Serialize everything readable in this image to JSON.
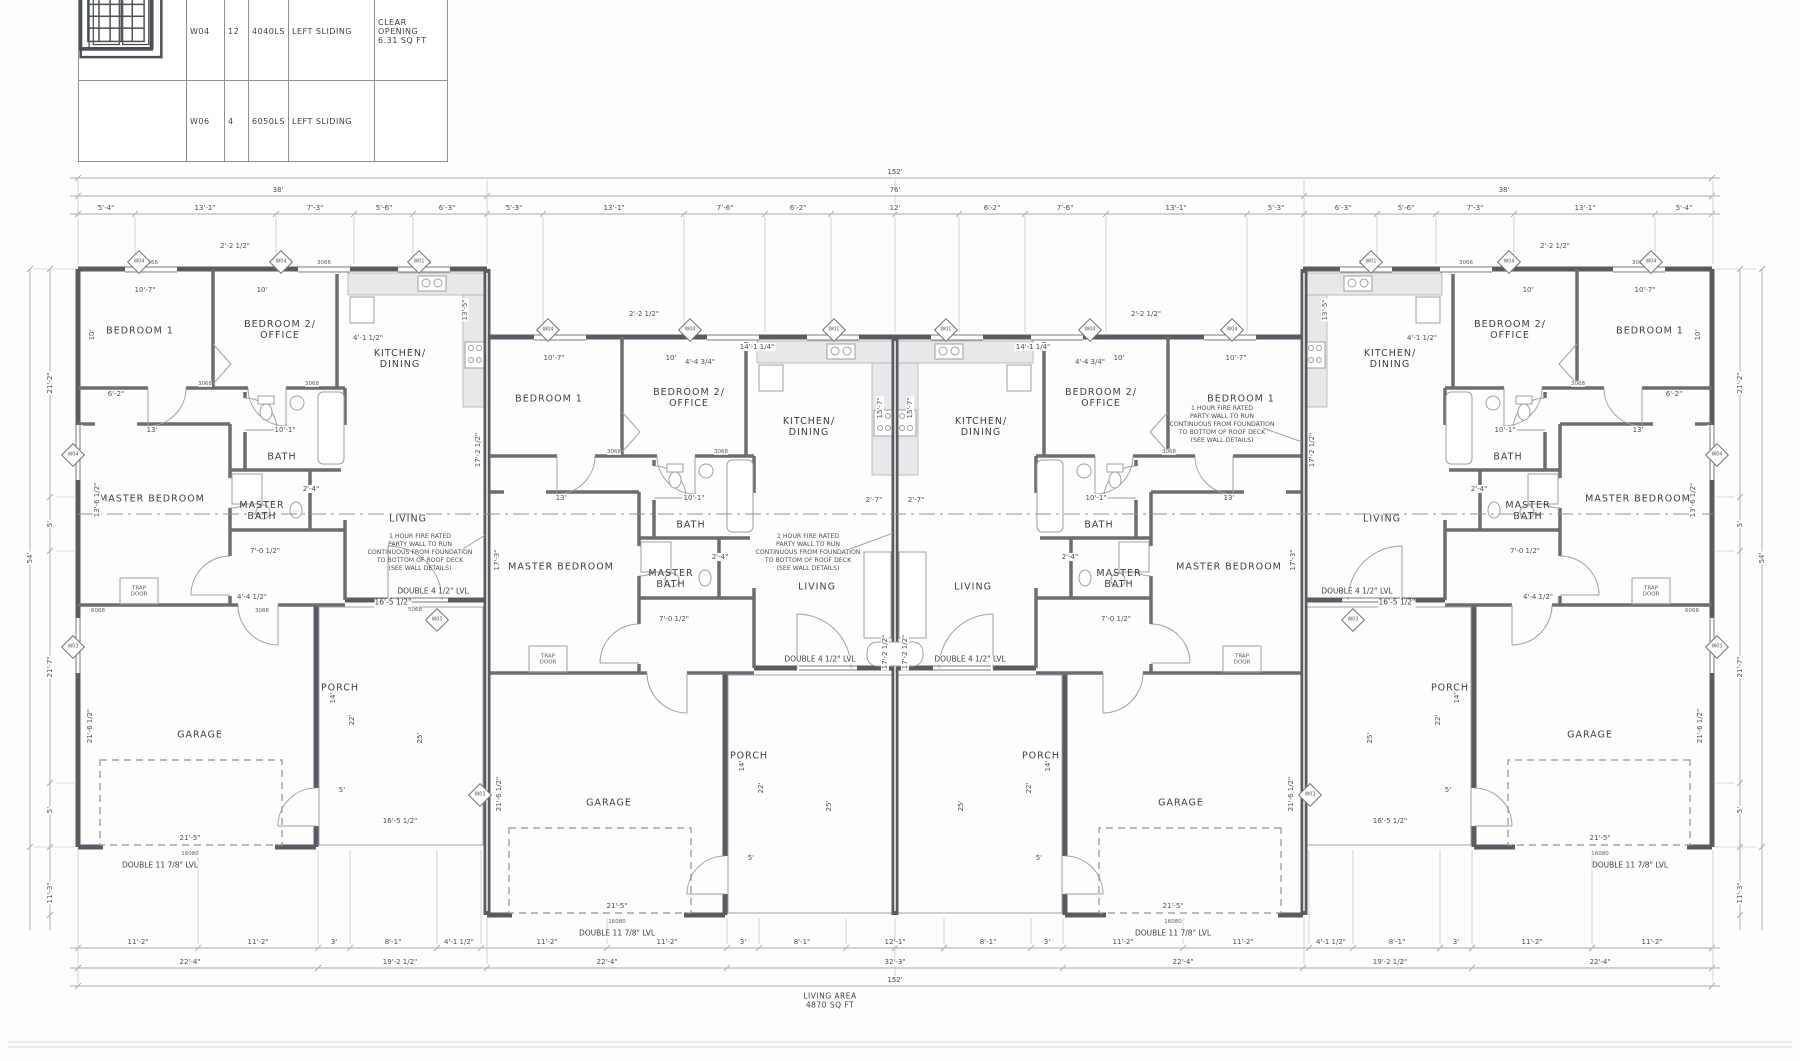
{
  "colors": {
    "wall": "#585c61",
    "interior_wall": "#6a6e73",
    "dim_text": "#4a4f55",
    "counter_fill": "#e7e8ea",
    "background": "#fdfdfd"
  },
  "schedule": {
    "rows": [
      {
        "glyph": "sliding-window",
        "id": "W04",
        "qty": "12",
        "size": "4040LS",
        "type": "LEFT SLIDING",
        "notes": "CLEAR OPENING\n6.31 SQ FT"
      },
      {
        "glyph": "grid-window",
        "id": "W06",
        "qty": "4",
        "size": "6050LS",
        "type": "LEFT SLIDING",
        "notes": ""
      }
    ]
  },
  "plan": {
    "living_area": {
      "t": "LIVING AREA|4870 SQ FT",
      "x": 830,
      "y": 1001
    },
    "rooms": [
      {
        "t": "BEDROOM 1",
        "x": 140,
        "y": 332
      },
      {
        "t": "BEDROOM 2/|OFFICE",
        "x": 280,
        "y": 331
      },
      {
        "t": "KITCHEN/|DINING",
        "x": 400,
        "y": 360
      },
      {
        "t": "BATH",
        "x": 282,
        "y": 458
      },
      {
        "t": "MASTER BEDROOM",
        "x": 152,
        "y": 500
      },
      {
        "t": "MASTER|BATH",
        "x": 262,
        "y": 512
      },
      {
        "t": "LIVING",
        "x": 408,
        "y": 520
      },
      {
        "t": "GARAGE",
        "x": 200,
        "y": 736
      },
      {
        "t": "PORCH",
        "x": 340,
        "y": 689
      },
      {
        "t": "BEDROOM 1",
        "x": 549,
        "y": 400
      },
      {
        "t": "BEDROOM 2/|OFFICE",
        "x": 689,
        "y": 399
      },
      {
        "t": "KITCHEN/|DINING",
        "x": 809,
        "y": 428
      },
      {
        "t": "BATH",
        "x": 691,
        "y": 526
      },
      {
        "t": "MASTER BEDROOM",
        "x": 561,
        "y": 568
      },
      {
        "t": "MASTER|BATH",
        "x": 671,
        "y": 580
      },
      {
        "t": "LIVING",
        "x": 817,
        "y": 588
      },
      {
        "t": "GARAGE",
        "x": 609,
        "y": 804
      },
      {
        "t": "PORCH",
        "x": 749,
        "y": 757
      },
      {
        "t": "BEDROOM 1",
        "x": 1241,
        "y": 400
      },
      {
        "t": "BEDROOM 2/|OFFICE",
        "x": 1101,
        "y": 399
      },
      {
        "t": "KITCHEN/|DINING",
        "x": 981,
        "y": 428
      },
      {
        "t": "BATH",
        "x": 1099,
        "y": 526
      },
      {
        "t": "MASTER BEDROOM",
        "x": 1229,
        "y": 568
      },
      {
        "t": "MASTER|BATH",
        "x": 1119,
        "y": 580
      },
      {
        "t": "LIVING",
        "x": 973,
        "y": 588
      },
      {
        "t": "GARAGE",
        "x": 1181,
        "y": 804
      },
      {
        "t": "PORCH",
        "x": 1041,
        "y": 757
      },
      {
        "t": "BEDROOM 1",
        "x": 1650,
        "y": 332
      },
      {
        "t": "BEDROOM 2/|OFFICE",
        "x": 1510,
        "y": 331
      },
      {
        "t": "KITCHEN/|DINING",
        "x": 1390,
        "y": 360
      },
      {
        "t": "BATH",
        "x": 1508,
        "y": 458
      },
      {
        "t": "MASTER BEDROOM",
        "x": 1638,
        "y": 500
      },
      {
        "t": "MASTER|BATH",
        "x": 1528,
        "y": 512
      },
      {
        "t": "LIVING",
        "x": 1382,
        "y": 520
      },
      {
        "t": "GARAGE",
        "x": 1590,
        "y": 736
      },
      {
        "t": "PORCH",
        "x": 1450,
        "y": 689
      }
    ],
    "notes": [
      {
        "t": "1 HOUR FIRE RATED|PARTY WALL TO RUN|CONTINUOUS FROM FOUNDATION|TO BOTTOM OF ROOF DECK|(SEE WALL DETAILS)",
        "x": 420,
        "y": 553
      },
      {
        "t": "1 HOUR FIRE RATED|PARTY WALL TO RUN|CONTINUOUS FROM FOUNDATION|TO BOTTOM OF ROOF DECK|(SEE WALL DETAILS)",
        "x": 808,
        "y": 553
      },
      {
        "t": "1 HOUR FIRE RATED|PARTY WALL TO RUN|CONTINUOUS FROM FOUNDATION|TO BOTTOM OF ROOF DECK|(SEE WALL DETAILS)",
        "x": 1222,
        "y": 425
      }
    ],
    "beams": [
      {
        "t": "DOUBLE 4 1/2\" LVL",
        "x": 433,
        "y": 592
      },
      {
        "t": "16'-5 1/2\"",
        "x": 393,
        "y": 603
      },
      {
        "t": "DOUBLE 4 1/2\" LVL",
        "x": 820,
        "y": 660
      },
      {
        "t": "DOUBLE 4 1/2\" LVL",
        "x": 970,
        "y": 660
      },
      {
        "t": "DOUBLE 4 1/2\" LVL",
        "x": 1357,
        "y": 592
      },
      {
        "t": "16'-5 1/2\"",
        "x": 1397,
        "y": 603
      },
      {
        "t": "DOUBLE 11 7/8\" LVL",
        "x": 160,
        "y": 866
      },
      {
        "t": "DOUBLE 11 7/8\" LVL",
        "x": 617,
        "y": 934
      },
      {
        "t": "DOUBLE 11 7/8\" LVL",
        "x": 1173,
        "y": 934
      },
      {
        "t": "DOUBLE 11 7/8\" LVL",
        "x": 1630,
        "y": 866
      }
    ],
    "window_tags": [
      {
        "t": "W04",
        "x": 139,
        "y": 262
      },
      {
        "t": "W04",
        "x": 281,
        "y": 262
      },
      {
        "t": "W01",
        "x": 419,
        "y": 262
      },
      {
        "t": "W04",
        "x": 548,
        "y": 330
      },
      {
        "t": "W04",
        "x": 690,
        "y": 330
      },
      {
        "t": "W01",
        "x": 834,
        "y": 330
      },
      {
        "t": "W01",
        "x": 946,
        "y": 330
      },
      {
        "t": "W04",
        "x": 1090,
        "y": 330
      },
      {
        "t": "W04",
        "x": 1232,
        "y": 330
      },
      {
        "t": "W01",
        "x": 1371,
        "y": 262
      },
      {
        "t": "W04",
        "x": 1509,
        "y": 262
      },
      {
        "t": "W04",
        "x": 1651,
        "y": 262
      },
      {
        "t": "W04",
        "x": 73,
        "y": 455
      },
      {
        "t": "W03",
        "x": 73,
        "y": 647
      },
      {
        "t": "W04",
        "x": 1717,
        "y": 455
      },
      {
        "t": "W03",
        "x": 1717,
        "y": 647
      },
      {
        "t": "W03",
        "x": 437,
        "y": 620
      },
      {
        "t": "W03",
        "x": 480,
        "y": 795
      },
      {
        "t": "W03",
        "x": 1353,
        "y": 620
      },
      {
        "t": "W03",
        "x": 1310,
        "y": 795
      }
    ],
    "dims": [
      {
        "t": "152'",
        "x": 895,
        "y": 172
      },
      {
        "t": "38'",
        "x": 278,
        "y": 190
      },
      {
        "t": "76'",
        "x": 895,
        "y": 190
      },
      {
        "t": "38'",
        "x": 1504,
        "y": 190
      },
      {
        "t": "5'-4\"",
        "x": 106,
        "y": 208
      },
      {
        "t": "13'-1\"",
        "x": 205,
        "y": 208
      },
      {
        "t": "7'-3\"",
        "x": 315,
        "y": 208
      },
      {
        "t": "5'-6\"",
        "x": 384,
        "y": 208
      },
      {
        "t": "6'-3\"",
        "x": 447,
        "y": 208
      },
      {
        "t": "5'-3\"",
        "x": 514,
        "y": 208
      },
      {
        "t": "13'-1\"",
        "x": 614,
        "y": 208
      },
      {
        "t": "7'-6\"",
        "x": 725,
        "y": 208
      },
      {
        "t": "6'-2\"",
        "x": 798,
        "y": 208
      },
      {
        "t": "12'",
        "x": 895,
        "y": 208
      },
      {
        "t": "6'-2\"",
        "x": 992,
        "y": 208
      },
      {
        "t": "7'-6\"",
        "x": 1065,
        "y": 208
      },
      {
        "t": "13'-1\"",
        "x": 1176,
        "y": 208
      },
      {
        "t": "5'-3\"",
        "x": 1276,
        "y": 208
      },
      {
        "t": "6'-3\"",
        "x": 1343,
        "y": 208
      },
      {
        "t": "5'-6\"",
        "x": 1406,
        "y": 208
      },
      {
        "t": "7'-3\"",
        "x": 1475,
        "y": 208
      },
      {
        "t": "13'-1\"",
        "x": 1585,
        "y": 208
      },
      {
        "t": "5'-4\"",
        "x": 1684,
        "y": 208
      },
      {
        "t": "2'-2 1/2\"",
        "x": 235,
        "y": 246
      },
      {
        "t": "2'-2 1/2\"",
        "x": 1555,
        "y": 246
      },
      {
        "t": "2'-2 1/2\"",
        "x": 644,
        "y": 314
      },
      {
        "t": "2'-2 1/2\"",
        "x": 1146,
        "y": 314
      },
      {
        "t": "11'-2\"",
        "x": 138,
        "y": 942
      },
      {
        "t": "11'-2\"",
        "x": 258,
        "y": 942
      },
      {
        "t": "3'",
        "x": 334,
        "y": 942
      },
      {
        "t": "8'-1\"",
        "x": 393,
        "y": 942
      },
      {
        "t": "4'-1 1/2\"",
        "x": 459,
        "y": 942
      },
      {
        "t": "11'-2\"",
        "x": 547,
        "y": 942
      },
      {
        "t": "11'-2\"",
        "x": 667,
        "y": 942
      },
      {
        "t": "3'",
        "x": 743,
        "y": 942
      },
      {
        "t": "8'-1\"",
        "x": 802,
        "y": 942
      },
      {
        "t": "12'-1\"",
        "x": 895,
        "y": 942
      },
      {
        "t": "8'-1\"",
        "x": 988,
        "y": 942
      },
      {
        "t": "3'",
        "x": 1047,
        "y": 942
      },
      {
        "t": "11'-2\"",
        "x": 1123,
        "y": 942
      },
      {
        "t": "11'-2\"",
        "x": 1243,
        "y": 942
      },
      {
        "t": "4'-1 1/2\"",
        "x": 1331,
        "y": 942
      },
      {
        "t": "8'-1\"",
        "x": 1397,
        "y": 942
      },
      {
        "t": "3'",
        "x": 1456,
        "y": 942
      },
      {
        "t": "11'-2\"",
        "x": 1532,
        "y": 942
      },
      {
        "t": "11'-2\"",
        "x": 1652,
        "y": 942
      },
      {
        "t": "22'-4\"",
        "x": 190,
        "y": 962
      },
      {
        "t": "19'-2 1/2\"",
        "x": 400,
        "y": 962
      },
      {
        "t": "22'-4\"",
        "x": 607,
        "y": 962
      },
      {
        "t": "32'-3\"",
        "x": 895,
        "y": 962
      },
      {
        "t": "22'-4\"",
        "x": 1183,
        "y": 962
      },
      {
        "t": "19'-2 1/2\"",
        "x": 1390,
        "y": 962
      },
      {
        "t": "22'-4\"",
        "x": 1600,
        "y": 962
      },
      {
        "t": "152'",
        "x": 895,
        "y": 980
      },
      {
        "t": "54'",
        "x": 30,
        "y": 558,
        "r": 1
      },
      {
        "t": "21'-2\"",
        "x": 50,
        "y": 383,
        "r": 1
      },
      {
        "t": "5'",
        "x": 50,
        "y": 524,
        "r": 1
      },
      {
        "t": "21'-7\"",
        "x": 50,
        "y": 667,
        "r": 1
      },
      {
        "t": "5'",
        "x": 50,
        "y": 810,
        "r": 1
      },
      {
        "t": "11'-3\"",
        "x": 50,
        "y": 893,
        "r": 1
      },
      {
        "t": "54'",
        "x": 1762,
        "y": 558,
        "r": 1
      },
      {
        "t": "21'-2\"",
        "x": 1740,
        "y": 383,
        "r": 1
      },
      {
        "t": "5'",
        "x": 1740,
        "y": 524,
        "r": 1
      },
      {
        "t": "21'-7\"",
        "x": 1740,
        "y": 667,
        "r": 1
      },
      {
        "t": "5'",
        "x": 1740,
        "y": 810,
        "r": 1
      },
      {
        "t": "11'-3\"",
        "x": 1740,
        "y": 893,
        "r": 1
      },
      {
        "t": "10'-7\"",
        "x": 145,
        "y": 290
      },
      {
        "t": "10'",
        "x": 262,
        "y": 290
      },
      {
        "t": "4'-1 1/2\"",
        "x": 368,
        "y": 338
      },
      {
        "t": "13'-5\"",
        "x": 465,
        "y": 310,
        "r": 1
      },
      {
        "t": "10'",
        "x": 92,
        "y": 335,
        "r": 1
      },
      {
        "t": "6'-2\"",
        "x": 116,
        "y": 394
      },
      {
        "t": "13'",
        "x": 152,
        "y": 430
      },
      {
        "t": "10'-1\"",
        "x": 285,
        "y": 430
      },
      {
        "t": "13'-6 1/2\"",
        "x": 97,
        "y": 500,
        "r": 1
      },
      {
        "t": "7'-0 1/2\"",
        "x": 265,
        "y": 551
      },
      {
        "t": "2'-4\"",
        "x": 311,
        "y": 489
      },
      {
        "t": "4'-4 1/2\"",
        "x": 252,
        "y": 597
      },
      {
        "t": "10'-7\"",
        "x": 1645,
        "y": 290
      },
      {
        "t": "10'",
        "x": 1528,
        "y": 290
      },
      {
        "t": "4'-1 1/2\"",
        "x": 1422,
        "y": 338
      },
      {
        "t": "13'-5\"",
        "x": 1325,
        "y": 310,
        "r": 1
      },
      {
        "t": "10'",
        "x": 1698,
        "y": 335,
        "r": 1
      },
      {
        "t": "6'-2\"",
        "x": 1674,
        "y": 394
      },
      {
        "t": "13'",
        "x": 1638,
        "y": 430
      },
      {
        "t": "10'-1\"",
        "x": 1505,
        "y": 430
      },
      {
        "t": "13'-6 1/2\"",
        "x": 1693,
        "y": 500,
        "r": 1
      },
      {
        "t": "7'-0 1/2\"",
        "x": 1525,
        "y": 551
      },
      {
        "t": "2'-4\"",
        "x": 1479,
        "y": 489
      },
      {
        "t": "4'-4 1/2\"",
        "x": 1538,
        "y": 597
      },
      {
        "t": "10'-7\"",
        "x": 554,
        "y": 358
      },
      {
        "t": "10'",
        "x": 671,
        "y": 358
      },
      {
        "t": "13'",
        "x": 561,
        "y": 498
      },
      {
        "t": "10'-1\"",
        "x": 694,
        "y": 498
      },
      {
        "t": "7'-0 1/2\"",
        "x": 674,
        "y": 619
      },
      {
        "t": "2'-4\"",
        "x": 720,
        "y": 557
      },
      {
        "t": "10'-7\"",
        "x": 1236,
        "y": 358
      },
      {
        "t": "10'",
        "x": 1119,
        "y": 358
      },
      {
        "t": "13'",
        "x": 1229,
        "y": 498
      },
      {
        "t": "10'-1\"",
        "x": 1096,
        "y": 498
      },
      {
        "t": "7'-0 1/2\"",
        "x": 1116,
        "y": 619
      },
      {
        "t": "2'-4\"",
        "x": 1070,
        "y": 557
      },
      {
        "t": "14'-1 1/4\"",
        "x": 757,
        "y": 347
      },
      {
        "t": "14'-1 1/4\"",
        "x": 1033,
        "y": 347
      },
      {
        "t": "4'-4 3/4\"",
        "x": 700,
        "y": 362
      },
      {
        "t": "4'-4 3/4\"",
        "x": 1090,
        "y": 362
      },
      {
        "t": "15'-7\"",
        "x": 880,
        "y": 408,
        "r": 1
      },
      {
        "t": "15'-7\"",
        "x": 910,
        "y": 408,
        "r": 1
      },
      {
        "t": "2'-7\"",
        "x": 874,
        "y": 500
      },
      {
        "t": "2'-7\"",
        "x": 916,
        "y": 500
      },
      {
        "t": "17'-2 1/2\"",
        "x": 885,
        "y": 652,
        "r": 1
      },
      {
        "t": "17'-2 1/2\"",
        "x": 905,
        "y": 652,
        "r": 1
      },
      {
        "t": "17'-3\"",
        "x": 497,
        "y": 560,
        "r": 1
      },
      {
        "t": "17'-3\"",
        "x": 1293,
        "y": 560,
        "r": 1
      },
      {
        "t": "17'-2 1/2\"",
        "x": 478,
        "y": 450,
        "r": 1
      },
      {
        "t": "17'-2 1/2\"",
        "x": 1312,
        "y": 450,
        "r": 1
      },
      {
        "t": "16'-5 1/2\"",
        "x": 400,
        "y": 821
      },
      {
        "t": "16'-5 1/2\"",
        "x": 1390,
        "y": 821
      },
      {
        "t": "21'-5\"",
        "x": 190,
        "y": 838
      },
      {
        "t": "21'-5\"",
        "x": 617,
        "y": 906
      },
      {
        "t": "21'-5\"",
        "x": 1173,
        "y": 906
      },
      {
        "t": "21'-5\"",
        "x": 1600,
        "y": 838
      },
      {
        "t": "21'-6 1/2\"",
        "x": 90,
        "y": 726,
        "r": 1
      },
      {
        "t": "21'-6 1/2\"",
        "x": 1700,
        "y": 726,
        "r": 1
      },
      {
        "t": "21'-6 1/2\"",
        "x": 499,
        "y": 794,
        "r": 1
      },
      {
        "t": "21'-6 1/2\"",
        "x": 1291,
        "y": 794,
        "r": 1
      },
      {
        "t": "14'",
        "x": 333,
        "y": 698,
        "r": 1
      },
      {
        "t": "22'",
        "x": 352,
        "y": 720,
        "r": 1
      },
      {
        "t": "25'",
        "x": 420,
        "y": 738,
        "r": 1
      },
      {
        "t": "5'",
        "x": 342,
        "y": 790
      },
      {
        "t": "14'",
        "x": 742,
        "y": 766,
        "r": 1
      },
      {
        "t": "22'",
        "x": 761,
        "y": 788,
        "r": 1
      },
      {
        "t": "25'",
        "x": 829,
        "y": 806,
        "r": 1
      },
      {
        "t": "5'",
        "x": 751,
        "y": 858
      },
      {
        "t": "14'",
        "x": 1048,
        "y": 766,
        "r": 1
      },
      {
        "t": "22'",
        "x": 1029,
        "y": 788,
        "r": 1
      },
      {
        "t": "25'",
        "x": 961,
        "y": 806,
        "r": 1
      },
      {
        "t": "5'",
        "x": 1039,
        "y": 858
      },
      {
        "t": "14'",
        "x": 1457,
        "y": 698,
        "r": 1
      },
      {
        "t": "22'",
        "x": 1438,
        "y": 720,
        "r": 1
      },
      {
        "t": "25'",
        "x": 1370,
        "y": 738,
        "r": 1
      },
      {
        "t": "5'",
        "x": 1448,
        "y": 790
      }
    ],
    "tiny": [
      {
        "t": "16080",
        "x": 190,
        "y": 854
      },
      {
        "t": "16080",
        "x": 617,
        "y": 922
      },
      {
        "t": "16080",
        "x": 1173,
        "y": 922
      },
      {
        "t": "16080",
        "x": 1600,
        "y": 854
      },
      {
        "t": "3068",
        "x": 205,
        "y": 384
      },
      {
        "t": "3068",
        "x": 312,
        "y": 384
      },
      {
        "t": "6068",
        "x": 98,
        "y": 611
      },
      {
        "t": "3068",
        "x": 262,
        "y": 611
      },
      {
        "t": "5068",
        "x": 415,
        "y": 610
      },
      {
        "t": "3068",
        "x": 614,
        "y": 452
      },
      {
        "t": "3068",
        "x": 721,
        "y": 452
      },
      {
        "t": "3068",
        "x": 1169,
        "y": 452
      },
      {
        "t": "3068",
        "x": 1578,
        "y": 384
      },
      {
        "t": "6068",
        "x": 1692,
        "y": 611
      },
      {
        "t": "3066",
        "x": 151,
        "y": 263
      },
      {
        "t": "3066",
        "x": 324,
        "y": 263
      },
      {
        "t": "3066",
        "x": 424,
        "y": 263
      },
      {
        "t": "3066",
        "x": 1366,
        "y": 263
      },
      {
        "t": "3066",
        "x": 1466,
        "y": 263
      },
      {
        "t": "3066",
        "x": 1639,
        "y": 263
      },
      {
        "t": "TRAP|DOOR",
        "x": 139,
        "y": 592
      },
      {
        "t": "TRAP|DOOR",
        "x": 548,
        "y": 660
      },
      {
        "t": "TRAP|DOOR",
        "x": 1242,
        "y": 660
      },
      {
        "t": "TRAP|DOOR",
        "x": 1651,
        "y": 592
      }
    ]
  }
}
